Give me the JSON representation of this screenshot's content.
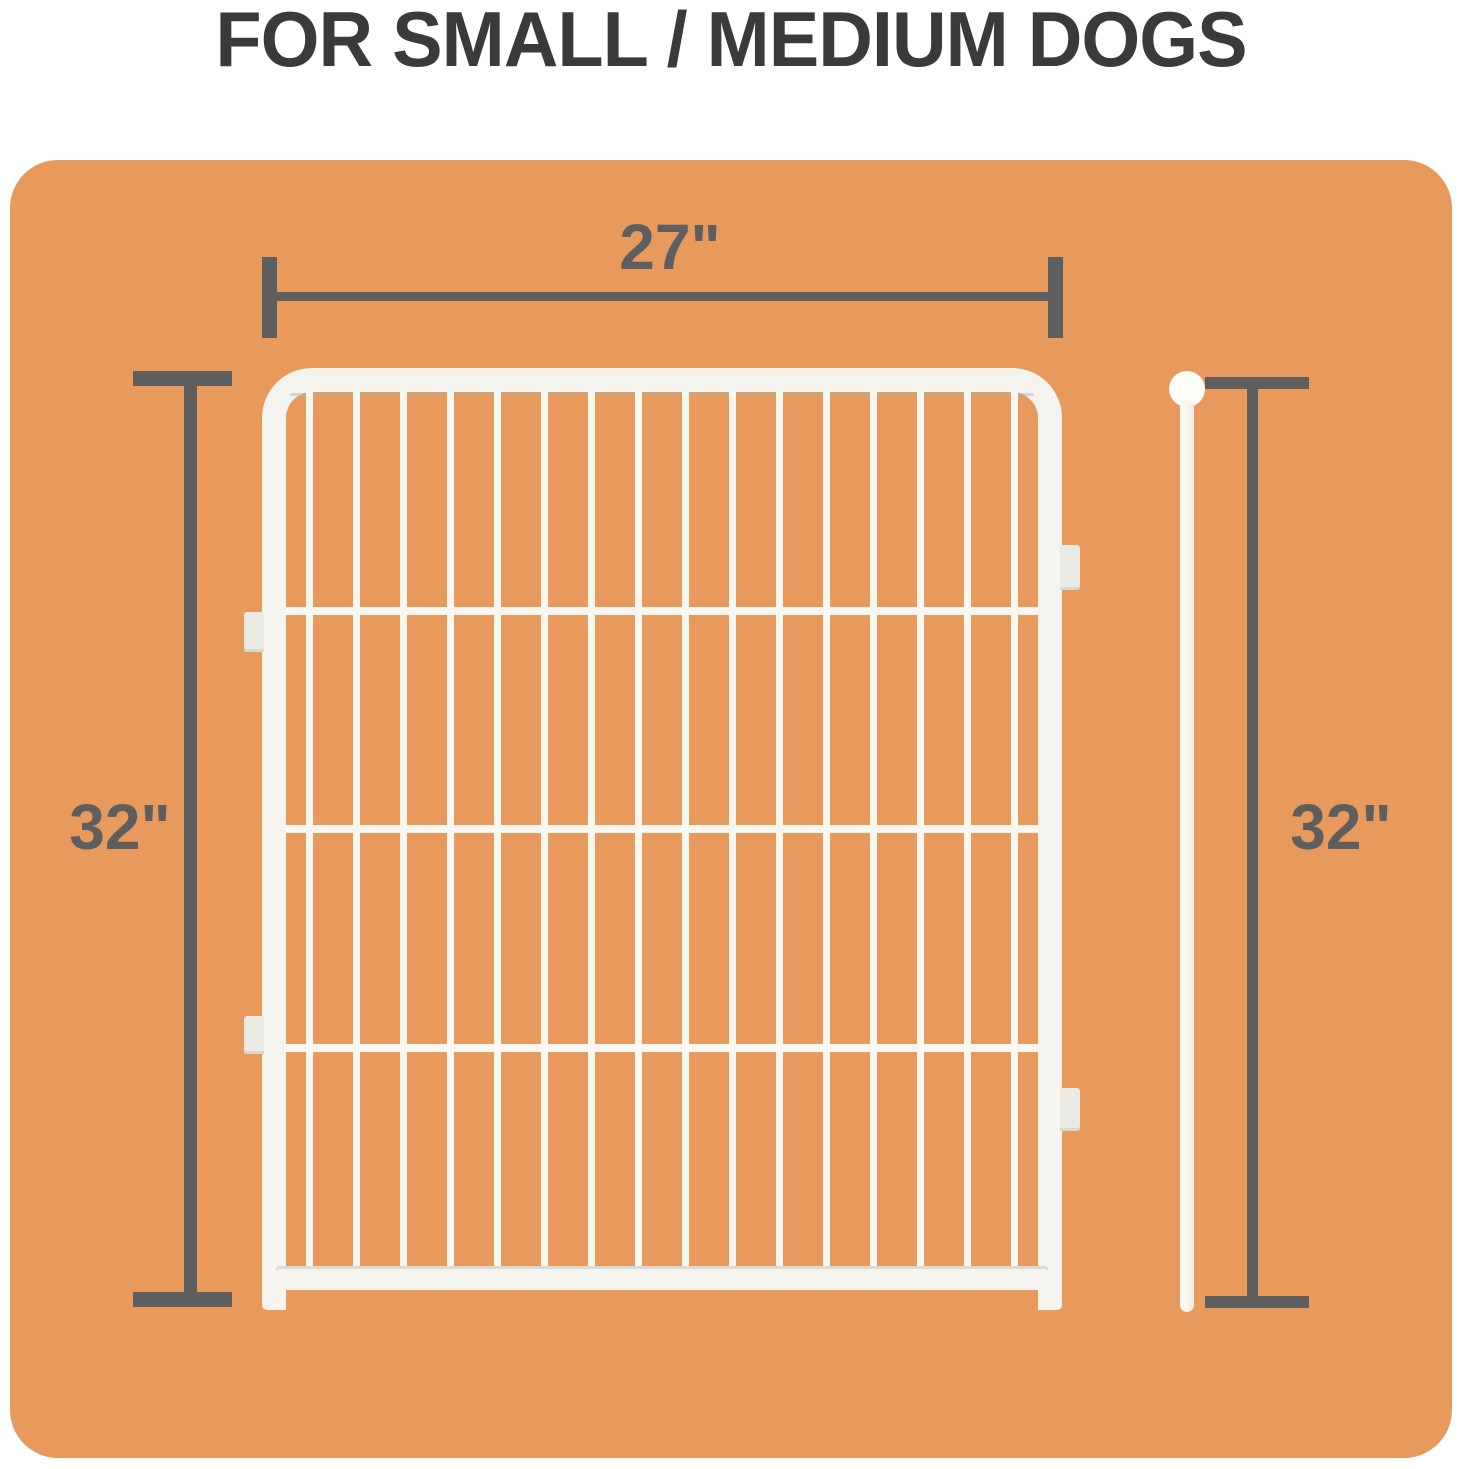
{
  "title": "FOR SMALL / MEDIUM DOGS",
  "colors": {
    "card_background": "#E8995C",
    "dimension": "#5E5E5E",
    "title_text": "#3A3A3A",
    "panel_white": "#F4F3EE",
    "wire_white": "#F7F6F1",
    "rod_white": "#FEFDF8"
  },
  "dimension_labels": {
    "width": "27\"",
    "height_left": "32\"",
    "height_right": "32\""
  },
  "panel": {
    "vertical_bar_count": 16,
    "horizontal_wire_count": 3,
    "left_connector_tab_count": 2,
    "right_connector_tab_count": 2
  }
}
